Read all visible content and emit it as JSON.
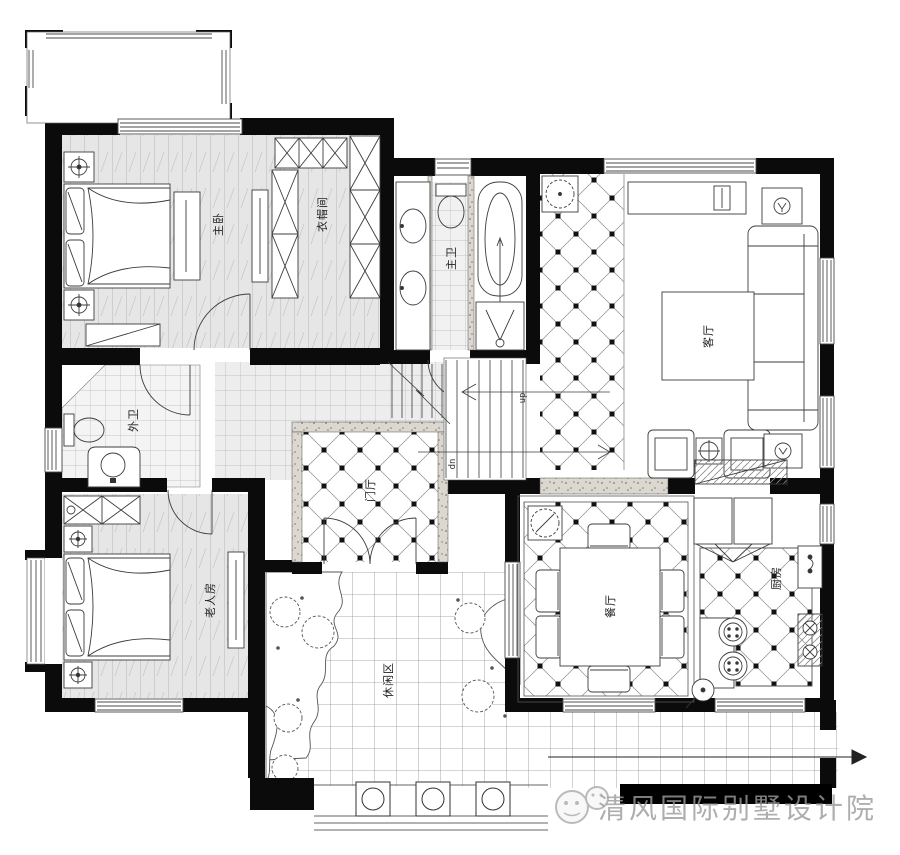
{
  "rooms": {
    "master_bedroom": "主卧",
    "closet": "衣帽间",
    "master_bath": "主卫",
    "living_room": "客厅",
    "foyer": "门厅",
    "guest_bath": "外卫",
    "elder_bedroom": "老人房",
    "dining_room": "餐厅",
    "kitchen": "厨房",
    "leisure_area": "休闲区"
  },
  "stairs": {
    "up": "up",
    "down": "dn"
  },
  "watermark": {
    "text": "清风国际别墅设计院",
    "icon": "wechat-icon"
  },
  "colors": {
    "wall": "#0b0b0b",
    "line": "#3c3c3c",
    "watermark_bar": "#000000",
    "watermark_text": "#9b9b9b"
  }
}
